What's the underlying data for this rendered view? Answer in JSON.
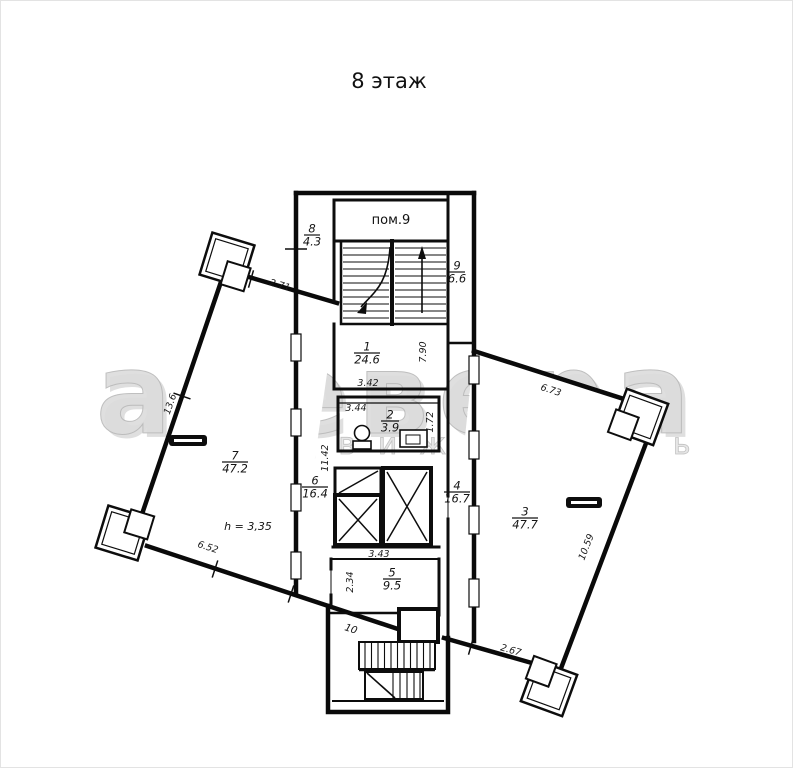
{
  "title": "8 этаж",
  "watermark": {
    "line1": "аревера",
    "line2": "недвижимость"
  },
  "plan": {
    "stairwell_label": "пом.9",
    "lower_stair_number": "10",
    "height_note": "h = 3,35",
    "rooms": [
      {
        "number": "1",
        "area": "24.6"
      },
      {
        "number": "2",
        "area": "3.9"
      },
      {
        "number": "3",
        "area": "47.7"
      },
      {
        "number": "4",
        "area": "16.7"
      },
      {
        "number": "5",
        "area": "9.5"
      },
      {
        "number": "6",
        "area": "16.4"
      },
      {
        "number": "7",
        "area": "47.2"
      },
      {
        "number": "8",
        "area": "4.3"
      },
      {
        "number": "9",
        "area": "6.6"
      }
    ],
    "dims": {
      "room1_width": "3.42",
      "room1_side": "7.90",
      "room2_left": "3.44",
      "room2_right": "1.72",
      "corridor_side": "11.42",
      "lift_width": "3.43",
      "room5_side": "2.34",
      "left_wing_top": "2.71",
      "left_wing_side": "13.6",
      "left_wing_bottom": "6.52",
      "right_wing_top": "6.73",
      "right_wing_side": "10.59",
      "right_wing_bottom": "2.67"
    }
  }
}
